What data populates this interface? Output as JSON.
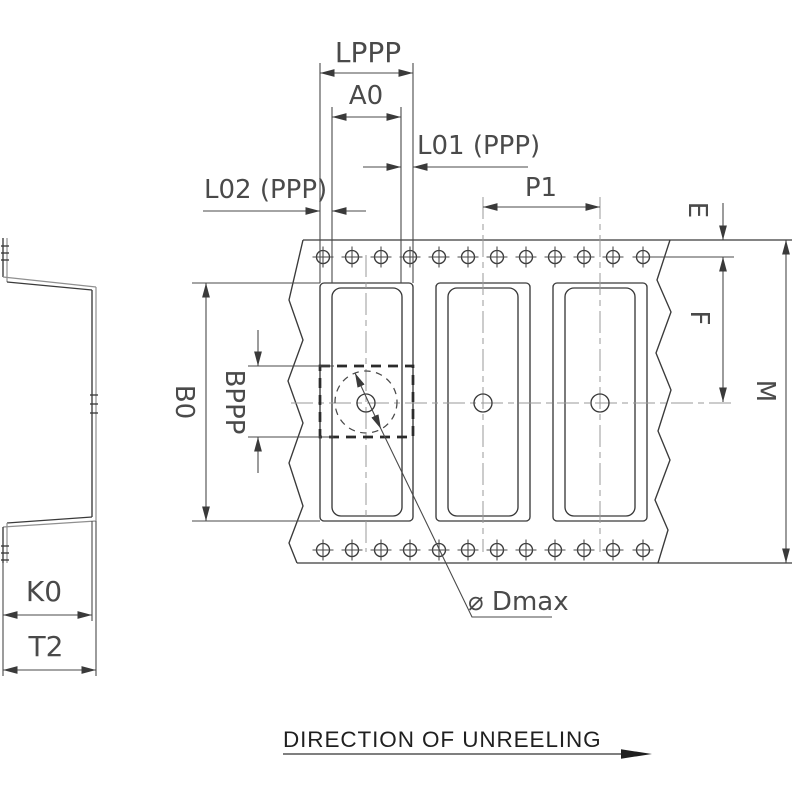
{
  "labels": {
    "lppp": "LPPP",
    "a0": "A0",
    "l01": "L01 (PPP)",
    "l02": "L02 (PPP)",
    "p1": "P1",
    "e": "E",
    "f": "F",
    "m": "M",
    "b0": "B0",
    "bppp": "BPPP",
    "k0": "K0",
    "t2": "T2",
    "dmax": "⌀ Dmax",
    "direction": "DIRECTION OF UNREELING"
  },
  "colors": {
    "background": "#ffffff",
    "outline": "#3a3a3a",
    "dimension_lines": "#4a4a4a",
    "centerline": "#9a9a9a",
    "label_text": "#4a4a4a",
    "direction_text": "#1f1f1f"
  }
}
